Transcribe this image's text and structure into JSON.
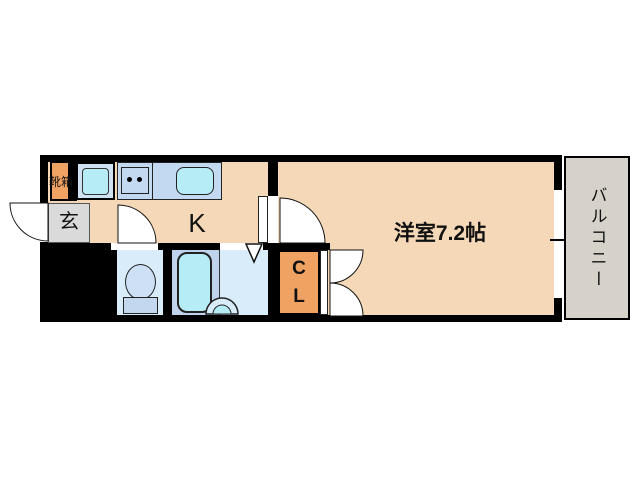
{
  "floorplan": {
    "type": "apartment-floor-plan",
    "rooms": {
      "kitchen": {
        "label": "K"
      },
      "western_room": {
        "label": "洋室7.2帖",
        "size_tatami": 7.2
      },
      "balcony": {
        "label": "バルコニー"
      },
      "entrance": {
        "label": "玄"
      },
      "shoe_box": {
        "label": "靴箱"
      },
      "closet": {
        "label": "CL"
      }
    },
    "fixtures": [
      "washing-machine-space",
      "two-burner-stove",
      "kitchen-sink",
      "toilet",
      "bathtub",
      "washbasin"
    ],
    "colors": {
      "wall": "#000000",
      "floor_peach": "#f4d8b8",
      "accent_orange": "#f0a263",
      "entrance_gray": "#dadada",
      "balcony_gray": "#d6d2c9",
      "wet_room_blue": "#d9ecfa",
      "bath_blue": "#bfd4ec",
      "fixture_cyan": "#b5ecf6",
      "counter_blue": "#c3d9f2"
    }
  }
}
